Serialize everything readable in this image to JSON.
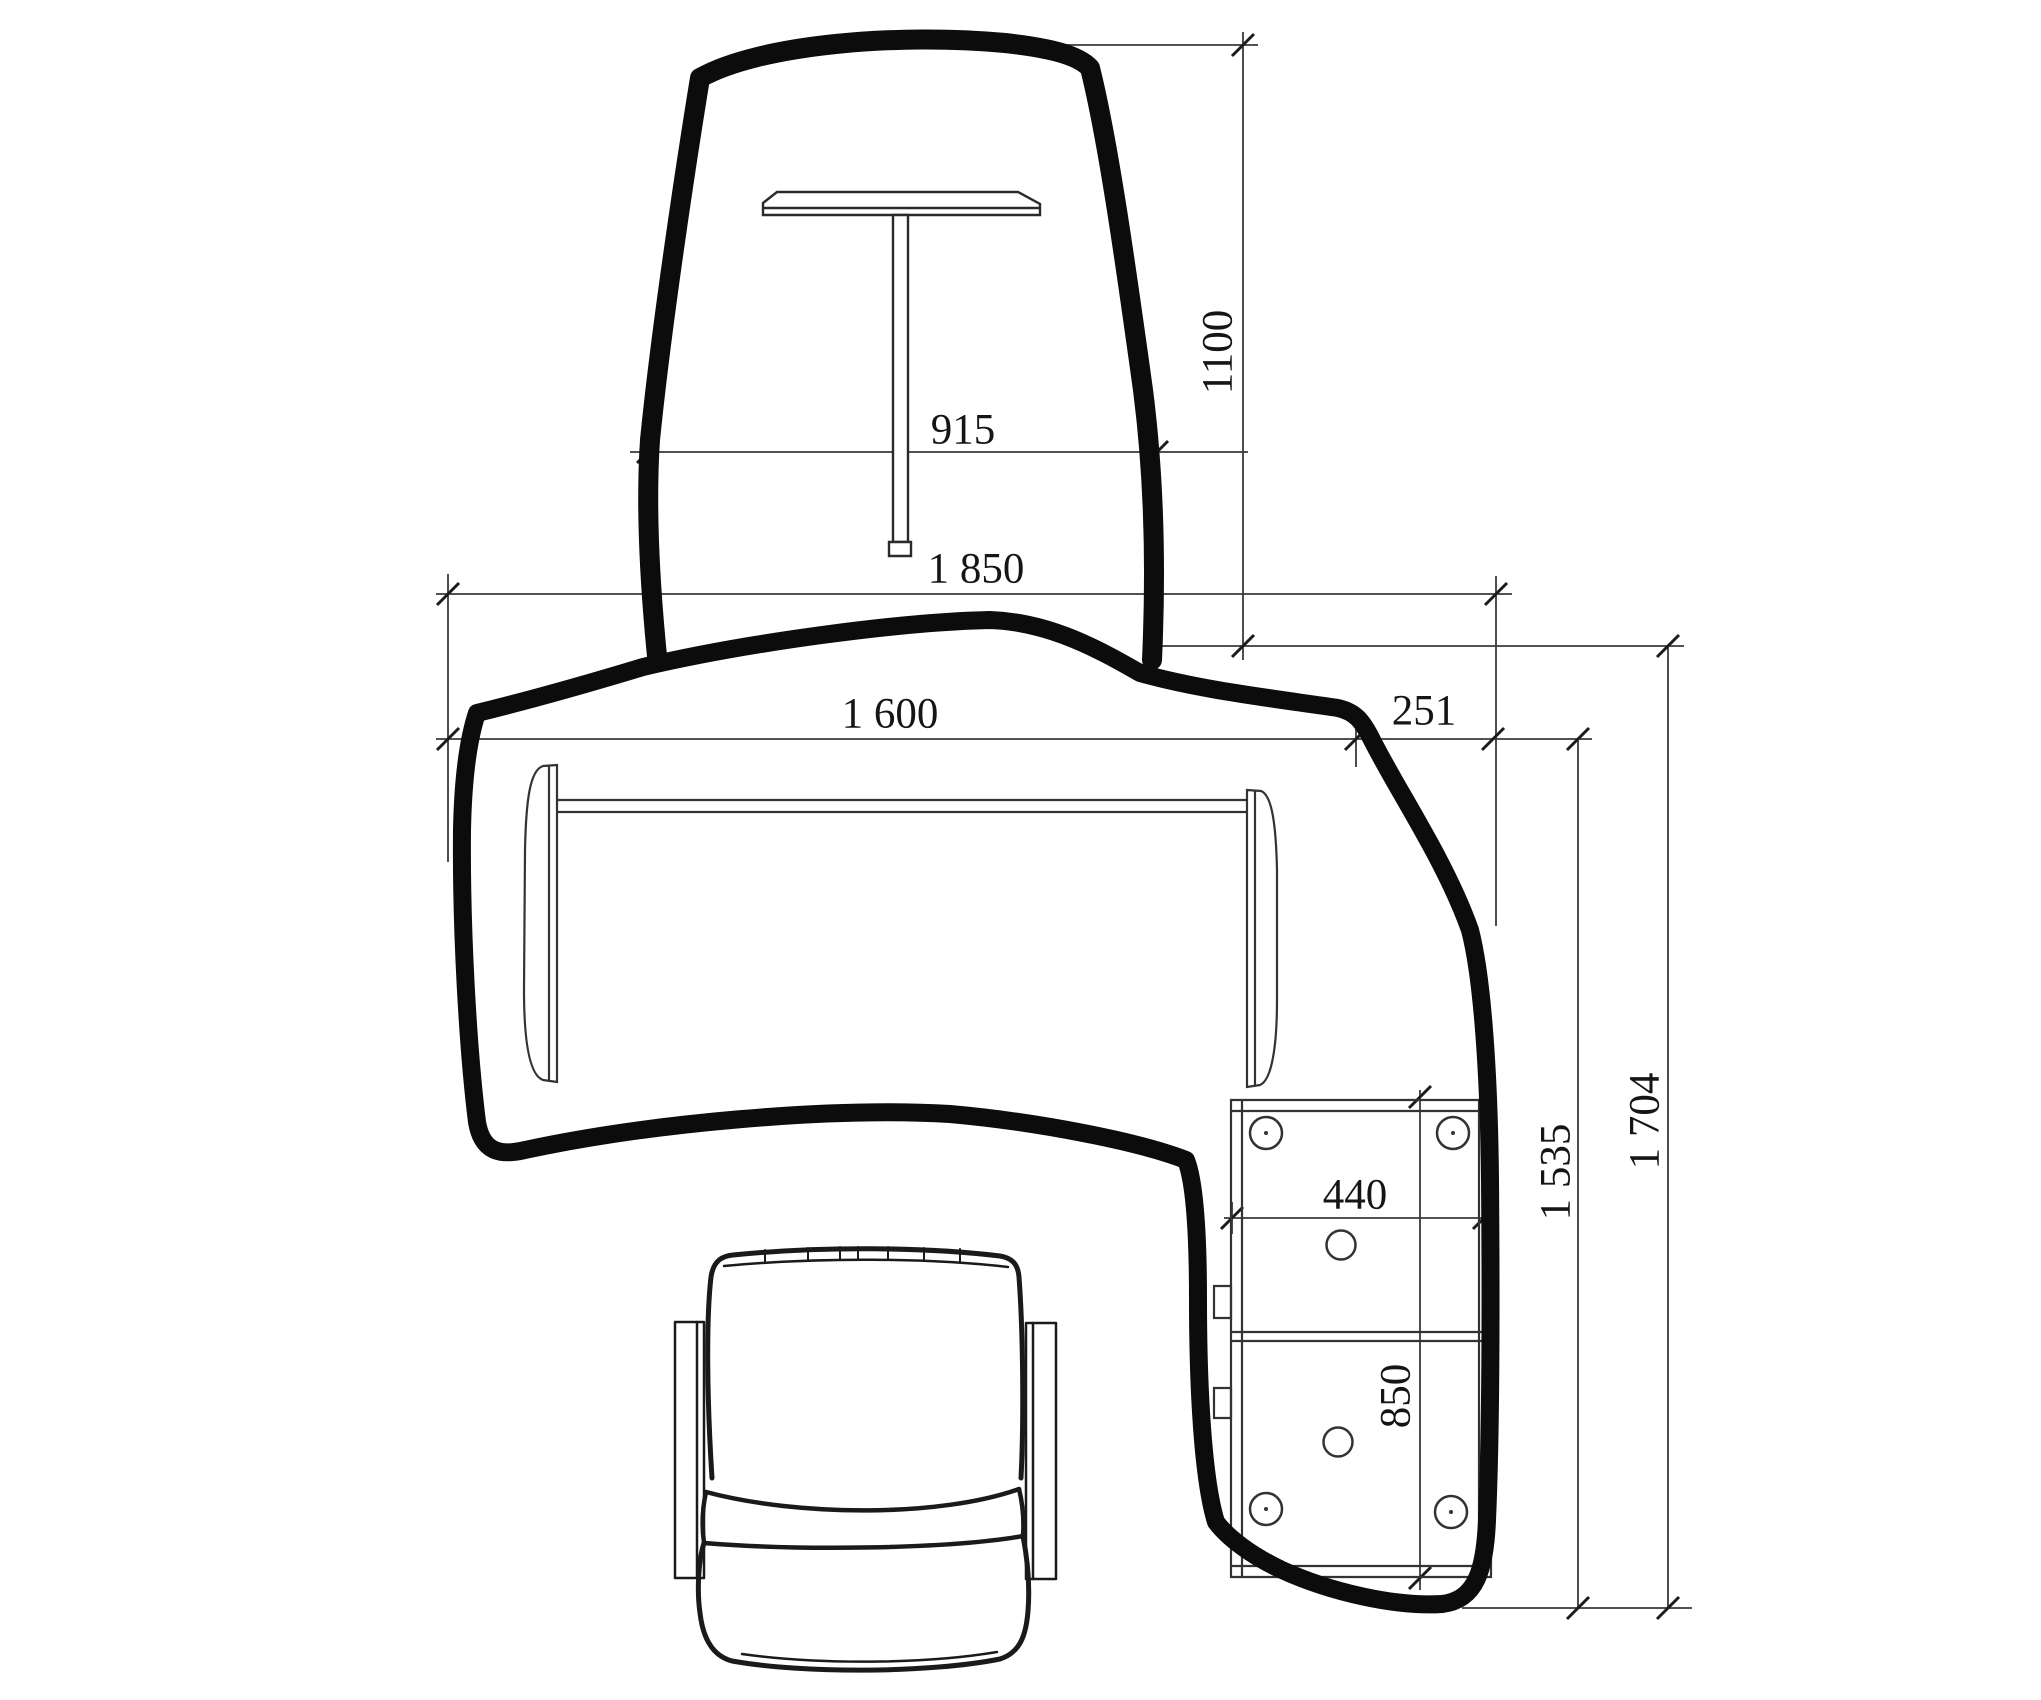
{
  "drawing": {
    "background_color": "#ffffff",
    "outline_color": "#0c0c0c",
    "thin_line_color": "#333333",
    "dimension_line_color": "#3a3a3a",
    "dimensions": {
      "screen_height": {
        "label": "1100",
        "orientation": "vertical"
      },
      "screen_width": {
        "label": "915",
        "orientation": "horizontal"
      },
      "overall_width": {
        "label": "1 850",
        "orientation": "horizontal"
      },
      "desk_width": {
        "label": "1 600",
        "orientation": "horizontal"
      },
      "return_offset": {
        "label": "251",
        "orientation": "horizontal"
      },
      "pedestal_width": {
        "label": "440",
        "orientation": "horizontal"
      },
      "pedestal_depth": {
        "label": "850",
        "orientation": "vertical"
      },
      "return_depth": {
        "label": "1 535",
        "orientation": "vertical"
      },
      "overall_depth": {
        "label": "1 704",
        "orientation": "vertical"
      }
    }
  }
}
